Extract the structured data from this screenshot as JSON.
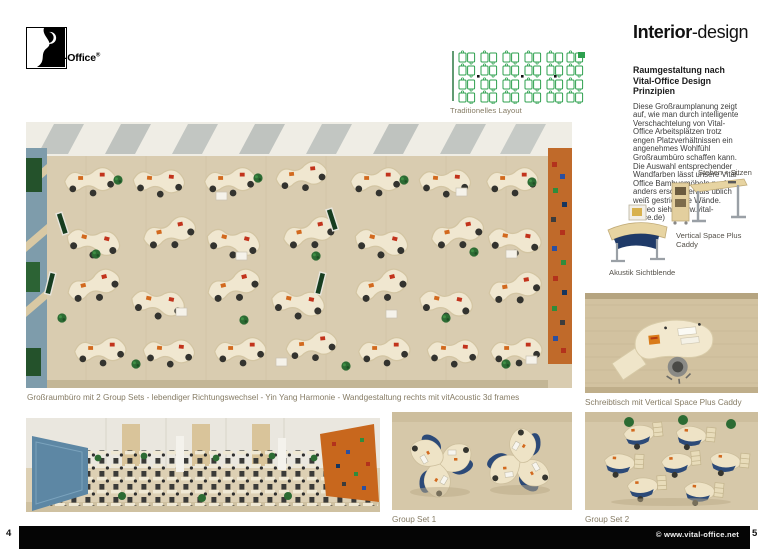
{
  "logo": {
    "brand": "Vital-Office",
    "registered": "®"
  },
  "diagram": {
    "caption": "Traditionelles Layout"
  },
  "article": {
    "title_bold": "Interior",
    "title_rest": "-design",
    "subtitle": "Raumgestaltung nach Vital-Office Design Prinzipien",
    "body": "Diese Großraumplanung zeigt auf, wie man durch intelligente Verschachtelung von Vital-Office Arbeitsplätzen trotz engen Platzverhältnissen ein angenehmes Wohlfühl Großraumbüro schaffen kann. Die Auswahl entsprechender Wandfarben lässt unsere Vital-Office Bambusmöbeln nochmal anders erscheinen als üblich weiß gestrichene Wände. (Video siehe www.vital-office.de)"
  },
  "products": {
    "standing_label": "Stehen + Sitzen",
    "caddy_label": "Vertical Space Plus Caddy",
    "screen_label": "Akustik Sichtblende"
  },
  "figures": {
    "main_caption": "Großraumbüro mit 2 Group Sets - lebendiger Richtungswechsel - Yin Yang Harmonie - Wandgestaltung rechts mit vitAcoustic 3d frames",
    "desk_caption": "Schreibtisch mit Vertical Space Plus Caddy",
    "group1_caption": "Group Set 1",
    "group2_caption": "Group Set 2"
  },
  "footer": {
    "left_page_number": "4",
    "right_page_number": "5",
    "copyright": "© www.vital-office.net"
  },
  "colors": {
    "floor": "#d9ccb0",
    "desk": "#f0e7d0",
    "diagram_green": "#2da04e",
    "wall_blue": "#6d93a6",
    "wall_orange": "#c06a2a",
    "panel_blue": "#1f3a68"
  }
}
